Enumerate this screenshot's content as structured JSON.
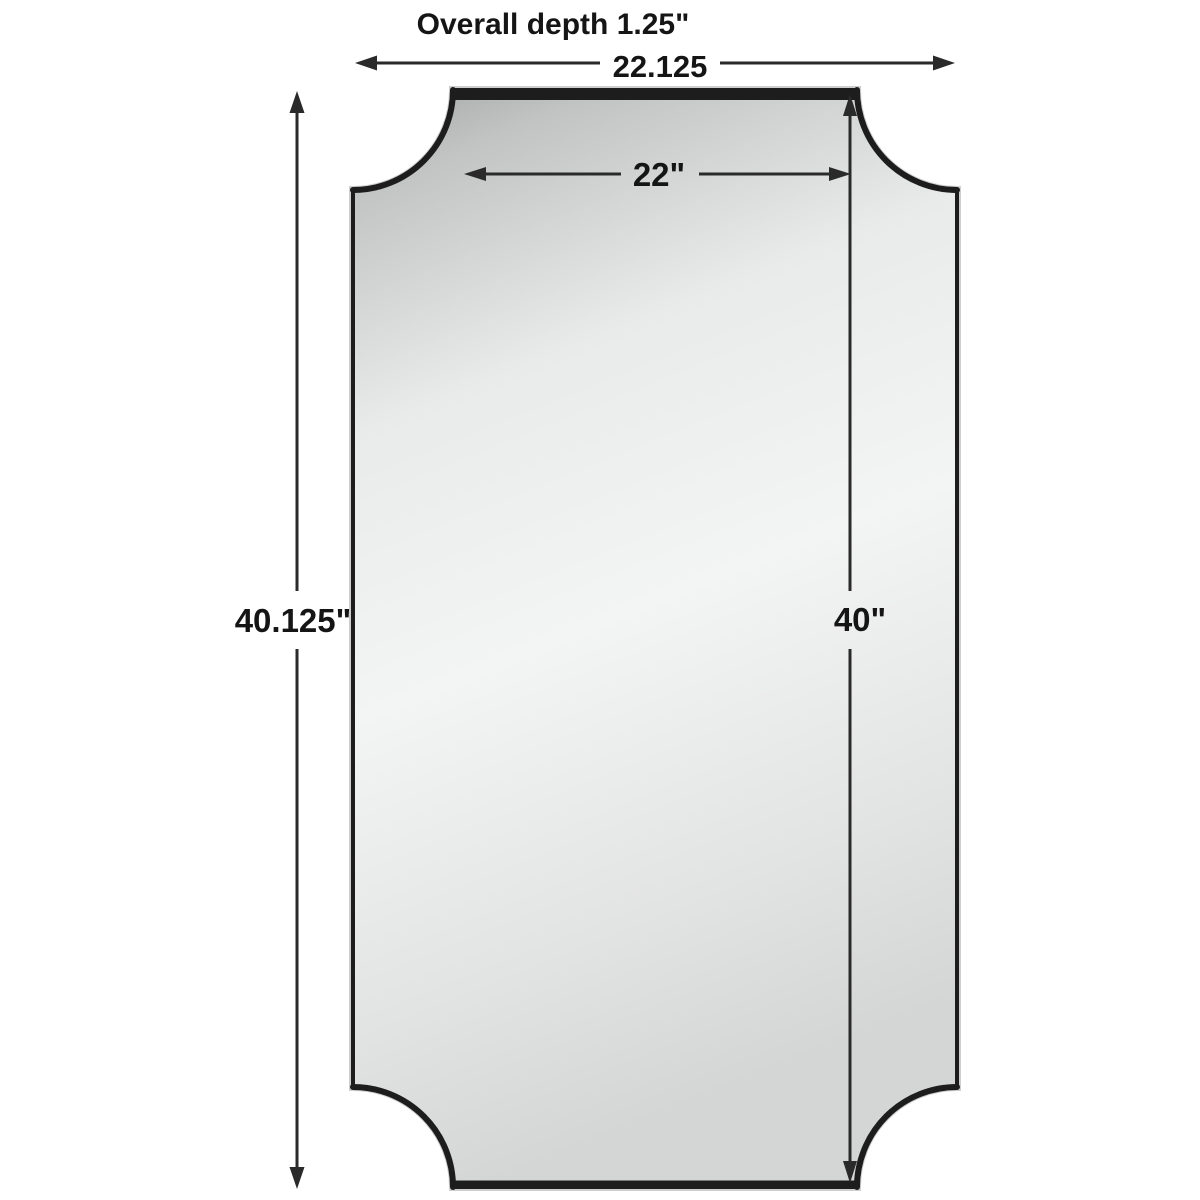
{
  "diagram": {
    "title": "Overall depth 1.25\"",
    "dimensions": {
      "overall_width": "22.125",
      "inner_width": "22\"",
      "overall_height": "40.125\"",
      "inner_height": "40\""
    },
    "colors": {
      "background": "#ffffff",
      "frame": "#1d1d1d",
      "frame_highlight": "#c9c9c9",
      "dimension_line": "#2a2a2a",
      "text": "#151515",
      "mirror_gradient": [
        "#a4a4a4",
        "#c2c4c4",
        "#e9ebeb",
        "#f3f4f4",
        "#e2e3e3",
        "#d4d5d5"
      ]
    }
  }
}
